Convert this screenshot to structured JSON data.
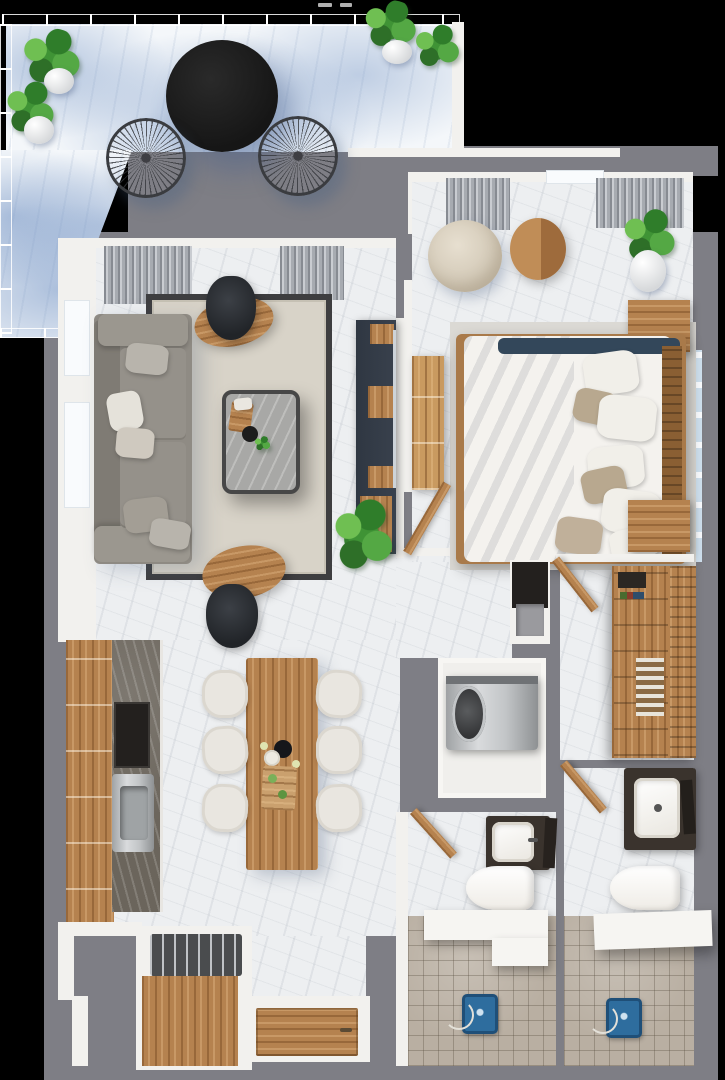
{
  "palette": {
    "bg": "#000000",
    "wall": "#7e7e85",
    "inner-wall": "#f2f1ee",
    "marble": "#edeff1",
    "marble-dark": "#6b655c",
    "terrace-blue": "#7494c4",
    "glass": "#a9c4e4",
    "wood": "#b5824f",
    "wood-dark": "#8a5f33",
    "wood-light": "#c99a60",
    "navy": "#39414d",
    "sofa": "#8f8b84",
    "sofa-light": "#9b978f",
    "rug": "#d8d3c8",
    "rug-border": "#3e3e40",
    "bed": "#f4f2ee",
    "pillow-taupe": "#b8a88f",
    "throw-navy": "#33475a",
    "chair-white": "#e9e6e0",
    "tile": "#b9afa2",
    "fixture-blue": "#2e6d9e",
    "vanity": "#3a332d",
    "steel": "#c6c9cb",
    "plant-green": "#3f9335",
    "table-black": "#161616",
    "curtain": "#a7abb1"
  },
  "rooms": [
    {
      "name": "terrace"
    },
    {
      "name": "living-room"
    },
    {
      "name": "bedroom"
    },
    {
      "name": "kitchen-dining"
    },
    {
      "name": "hallway"
    },
    {
      "name": "walk-in-closet"
    },
    {
      "name": "laundry-closet"
    },
    {
      "name": "bathroom-1"
    },
    {
      "name": "bathroom-2"
    },
    {
      "name": "entry"
    }
  ],
  "artifacts": {
    "top_speck_count": 2
  }
}
